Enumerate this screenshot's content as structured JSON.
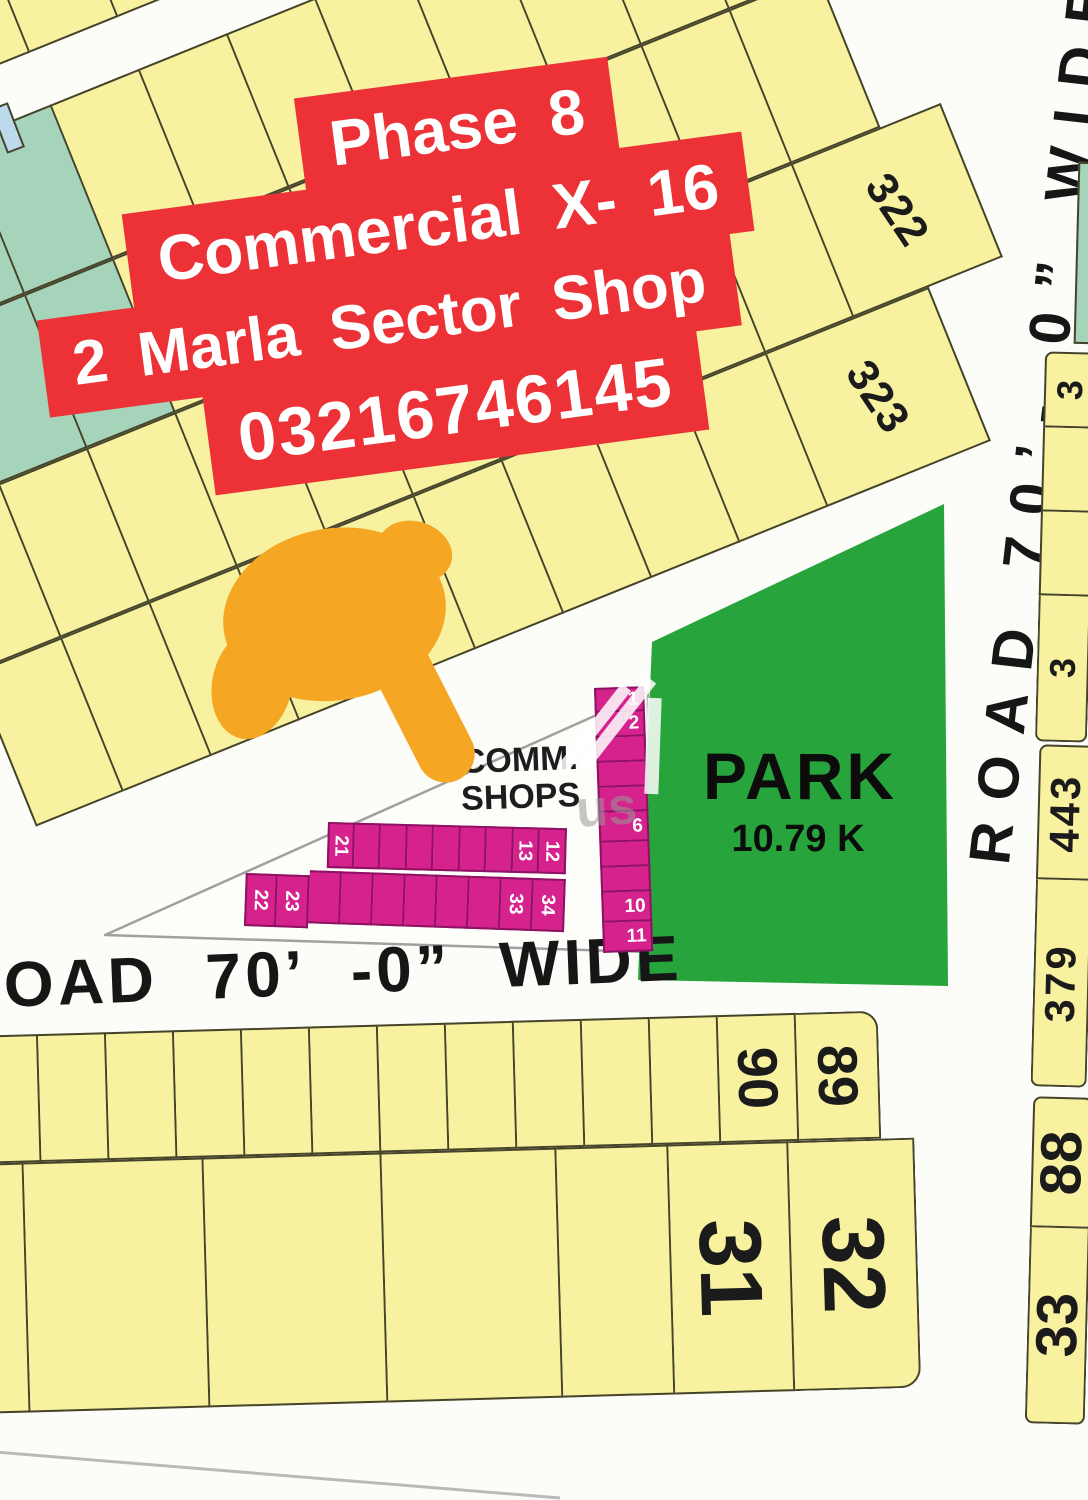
{
  "banners": {
    "line1": "Phase 8",
    "line2": "Commercial  X- 16",
    "line3": "2 Marla  Sector  Shop",
    "line4": "03216746145"
  },
  "roads": {
    "right_vertical": "ROAD 70’- 0” WIDE",
    "bottom": "ROAD 70’ -0” WIDE"
  },
  "park": {
    "name": "PARK",
    "area": "10.79 K"
  },
  "shops_label": {
    "line1": "COMM.",
    "line2": "SHOPS"
  },
  "watermark": "us",
  "map": {
    "band_rows": {
      "top": [
        "",
        "",
        "",
        "",
        "",
        "",
        "",
        ""
      ],
      "r1": [
        "",
        {
          "c": "t"
        },
        {
          "c": "t"
        },
        "",
        "",
        "",
        "",
        "",
        "",
        "",
        "",
        ""
      ],
      "r2": [
        {
          "c": "t"
        },
        {
          "c": "t"
        },
        {
          "c": "t"
        },
        "",
        "",
        "",
        "",
        "",
        "",
        "",
        ""
      ],
      "r3": [
        "",
        "",
        "",
        "",
        "",
        "",
        "",
        "",
        "",
        "",
        {
          "l": "322",
          "w": 160
        }
      ],
      "r4": [
        "",
        "",
        "",
        "",
        "",
        "",
        "",
        "",
        "",
        {
          "l": "323",
          "w": 175
        }
      ]
    },
    "shops_column": [
      "1",
      "2",
      "",
      "",
      "",
      {
        "l": "6",
        "h": 30
      },
      "",
      "",
      {
        "l": "10",
        "h": 30
      },
      {
        "l": "11",
        "h": 30
      }
    ],
    "shops_row_upper": [
      "21",
      "",
      "",
      "",
      "",
      "",
      "",
      "13",
      "12"
    ],
    "shops_row_lower": [
      "22",
      "23",
      "",
      "",
      "",
      "",
      "",
      "",
      "33",
      "34"
    ],
    "bottom_row_upper": [
      "",
      "",
      "",
      "",
      "",
      "",
      "",
      "",
      "",
      "",
      "",
      {
        "l": "90",
        "w": 78
      },
      {
        "l": "89",
        "w": 82
      }
    ],
    "bottom_row_lower": [
      {
        "w": 50
      },
      {
        "w": 180
      },
      {
        "w": 178
      },
      {
        "w": 175
      },
      {
        "w": 112
      },
      {
        "l": "31",
        "w": 120
      },
      {
        "l": "32",
        "w": 126
      }
    ],
    "right_strip_top": [
      {
        "l": "3",
        "h": 76
      },
      {
        "h": 84
      },
      {
        "h": 84
      },
      {
        "l": "3",
        "h": 146
      }
    ],
    "right_strip_mid": [
      {
        "l": "443",
        "h": 135
      },
      {
        "l": "379",
        "h": 207
      }
    ],
    "right_strip_low": [
      {
        "l": "88",
        "h": 131
      },
      {
        "l": "33",
        "h": 196
      }
    ]
  },
  "colors": {
    "plot_yellow": "#f8f2a0",
    "plot_border": "#45442a",
    "teal": "#a5d4ba",
    "blue": "#bcdaec",
    "park_green": "#27a43b",
    "shop_pink": "#d6228c",
    "shop_border": "#8e1263",
    "banner_red": "#ed3237",
    "ink": "#161616",
    "hand": "#f5a623"
  }
}
